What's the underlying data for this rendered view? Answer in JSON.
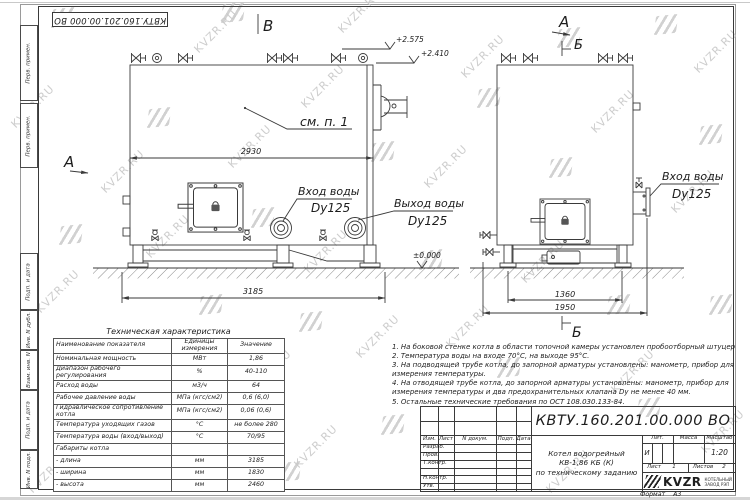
{
  "doc": {
    "number": "КВТУ.160.201.00.000 ВО"
  },
  "watermark": {
    "text": "KVZR.RU",
    "positions": [
      [
        5,
        100
      ],
      [
        30,
        285
      ],
      [
        22,
        465
      ],
      [
        95,
        165
      ],
      [
        140,
        230
      ],
      [
        128,
        455
      ],
      [
        188,
        25
      ],
      [
        222,
        140
      ],
      [
        242,
        365
      ],
      [
        295,
        80
      ],
      [
        298,
        245
      ],
      [
        288,
        440
      ],
      [
        332,
        5
      ],
      [
        418,
        160
      ],
      [
        440,
        320
      ],
      [
        455,
        50
      ],
      [
        515,
        255
      ],
      [
        540,
        465
      ],
      [
        585,
        105
      ],
      [
        605,
        365
      ],
      [
        665,
        185
      ],
      [
        688,
        45
      ],
      [
        695,
        425
      ],
      [
        350,
        330
      ]
    ],
    "logos": [
      [
        52,
        8
      ],
      [
        222,
        3
      ],
      [
        148,
        108
      ],
      [
        252,
        208
      ],
      [
        372,
        142
      ],
      [
        300,
        312
      ],
      [
        420,
        250
      ],
      [
        478,
        88
      ],
      [
        550,
        158
      ],
      [
        608,
        295
      ],
      [
        655,
        15
      ],
      [
        700,
        125
      ],
      [
        638,
        398
      ],
      [
        498,
        358
      ],
      [
        200,
        295
      ],
      [
        102,
        352
      ],
      [
        558,
        28
      ],
      [
        710,
        295
      ],
      [
        382,
        415
      ],
      [
        278,
        462
      ],
      [
        60,
        225
      ],
      [
        170,
        395
      ]
    ]
  },
  "margins": {
    "top_boxes": [
      "Перв. примен.",
      "Перв. примен."
    ],
    "bottom_boxes": [
      "Подп. и дата",
      "Инв. N дубл.",
      "Взам. инв. N",
      "Подп. и дата",
      "Инв. N подл."
    ]
  },
  "drawing": {
    "view_b_label": "В",
    "view_a_label_left": "А",
    "view_a_label_right": "А",
    "view_b_label_top": "Б",
    "view_b_label_bottom": "Б",
    "elev_top": "+2.575",
    "elev_mid": "+2.410",
    "elev_zero": "±0.000",
    "see_note": "см. п. 1",
    "dim_2930": "2930",
    "dim_3185": "3185",
    "dim_1360": "1360",
    "dim_1950": "1950",
    "inlet_label": "Вход воды",
    "inlet_dn": "Dy125",
    "outlet_label": "Выход воды",
    "outlet_dn": "Dy125",
    "inlet_right_label": "Вход воды",
    "inlet_right_dn": "Dy125"
  },
  "tech_table": {
    "title": "Техническая характеристика",
    "headers": [
      "Наименование показателя",
      "Единицы измерения",
      "Значение"
    ],
    "rows": [
      {
        "name": "Номинальная мощность",
        "unit": "МВт",
        "value": "1,86"
      },
      {
        "name": "Диапазон рабочего регулирования",
        "unit": "%",
        "value": "40-110"
      },
      {
        "name": "Расход воды",
        "unit": "м3/ч",
        "value": "64"
      },
      {
        "name": "Рабочее давление воды",
        "unit": "МПа (кгс/см2)",
        "value": "0,6 (6,0)"
      },
      {
        "name": "Гидравлическое сопротивление котла",
        "unit": "МПа (кгс/см2)",
        "value": "0,06 (0,6)"
      },
      {
        "name": "Температура уходящих газов",
        "unit": "°С",
        "value": "не более 280"
      },
      {
        "name": "Температура воды (вход/выход)",
        "unit": "°С",
        "value": "70/95"
      },
      {
        "name": "Габариты котла",
        "unit": "",
        "value": ""
      },
      {
        "name": "- длина",
        "unit": "мм",
        "value": "3185"
      },
      {
        "name": "- ширина",
        "unit": "мм",
        "value": "1830"
      },
      {
        "name": "- высота",
        "unit": "мм",
        "value": "2460"
      }
    ]
  },
  "notes": {
    "lines": [
      "1.  На боковой стенке котла в области топочной камеры установлен пробоотборный штуцер",
      "2.  Температура воды на входе 70°С, на выходе 95°С.",
      "3.  На подводящей трубе котла, до запорной арматуры установлены: манометр, прибор для",
      "измерения температуры.",
      "4.  На отводящей трубе котла, до запорной арматуры установлены: манометр, прибор для",
      "измерения температуры и два предохранительных клапана Dу не менее 40 мм.",
      "5.  Остальные технические требования по ОСТ 108.030.133-84."
    ]
  },
  "title_block": {
    "rev_header": [
      "Изм.",
      "Лист",
      "N докум.",
      "Подп.",
      "Дата"
    ],
    "roles": [
      "Разраб.",
      "Пров.",
      "Т.контр.",
      "Н.контр.",
      "Утв."
    ],
    "title_lines": [
      "Котел водогрейный",
      "КВ-1,86 КБ (К)",
      "по техническому заданию"
    ],
    "lit_header": [
      "Лит.",
      "Масса",
      "Масштаб"
    ],
    "lit_value": "И",
    "scale": "1:20",
    "sheet_label": "Лист",
    "sheet_value": "1",
    "sheets_label": "Листов",
    "sheets_value": "2",
    "logo_text": "KVZR",
    "logo_sub1": "КОТЕЛЬНЫЙ",
    "logo_sub2": "ЗАВОД РЭП",
    "format_label": "Формат",
    "format_value": "А3"
  }
}
